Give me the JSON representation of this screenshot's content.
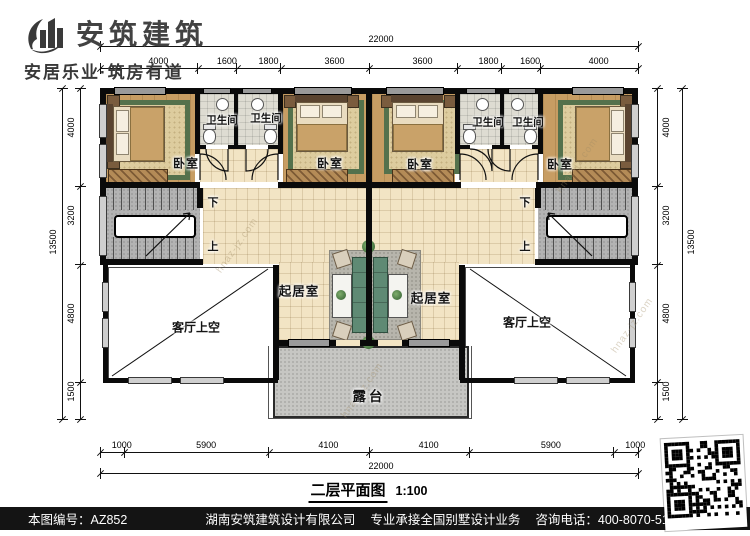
{
  "header": {
    "company_name": "安筑建筑",
    "tagline": "安居乐业·筑房有道"
  },
  "plan": {
    "caption_title": "二层平面图",
    "caption_scale": "1:100",
    "labels": {
      "bedroom": "卧室",
      "bathroom": "卫生间",
      "living_room": "起居室",
      "living_void": "客厅上空",
      "terrace": "露台",
      "down": "下",
      "up": "上"
    },
    "watermark": "hnaz-jz.com"
  },
  "dimensions": {
    "top": {
      "overall": "22000",
      "segments": [
        "4000",
        "1600",
        "1800",
        "3600",
        "3600",
        "1800",
        "1600",
        "4000"
      ]
    },
    "bottom": {
      "overall": "22000",
      "segments": [
        "1000",
        "5900",
        "4100",
        "4100",
        "5900",
        "1000"
      ]
    },
    "left": {
      "overall": "13500",
      "segments": [
        "4000",
        "3200",
        "4800",
        "1500"
      ]
    },
    "right": {
      "overall": "13500",
      "segments": [
        "4000",
        "3200",
        "4800",
        "1500"
      ]
    }
  },
  "footer": {
    "drawing_no": "本图编号：AZ852",
    "company": "湖南安筑建筑设计有限公司",
    "services": "专业承接全国别墅设计业务",
    "phone": "咨询电话：400-8070-511",
    "web": "网"
  },
  "colors": {
    "wall": "#0a0a0a",
    "wood_floor": "#c79d63",
    "tile_floor": "#f2e4c4",
    "bath_tile": "#dedcd2",
    "stair_gray": "#b3b3b3",
    "terrace_gray": "#c6c6c3",
    "rug_green": "#54714c",
    "footer_bg": "#141414"
  }
}
